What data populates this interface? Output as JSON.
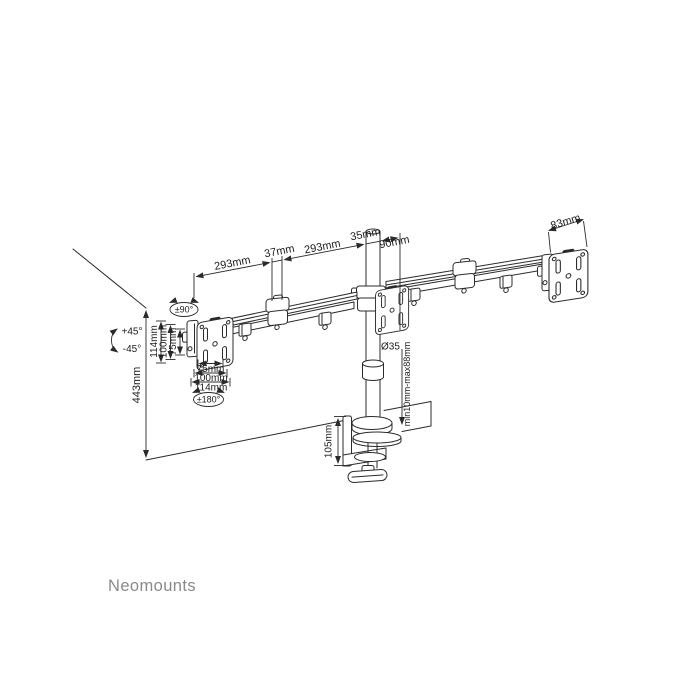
{
  "brand": {
    "name": "Neomounts"
  },
  "dimensions": {
    "arm_segments": {
      "left_arm_reach": "293mm",
      "elbow_joint": "37mm",
      "inner_arm_reach": "293mm",
      "pole_width": "35mm",
      "head_offset": "90mm"
    },
    "head_plate_width": "83mm",
    "pole": {
      "height": "443mm",
      "diameter": "Ø35"
    },
    "vesa": {
      "vertical": [
        "114mm",
        "100mm",
        "75mm"
      ],
      "horizontal": [
        "75mm",
        "100mm",
        "114mm"
      ]
    },
    "clamp": {
      "bracket_height": "105mm",
      "desk_thickness_range": "min10mm-max88mm"
    }
  },
  "rotation": {
    "tilt_up": "+45°",
    "tilt_down": "-45°",
    "swivel": "±90°",
    "vesa_rotation": "±180°"
  },
  "colors": {
    "line": "#2b2b2b",
    "text": "#1c1c1c",
    "brand_text": "#8a8a8a",
    "background": "#ffffff"
  }
}
